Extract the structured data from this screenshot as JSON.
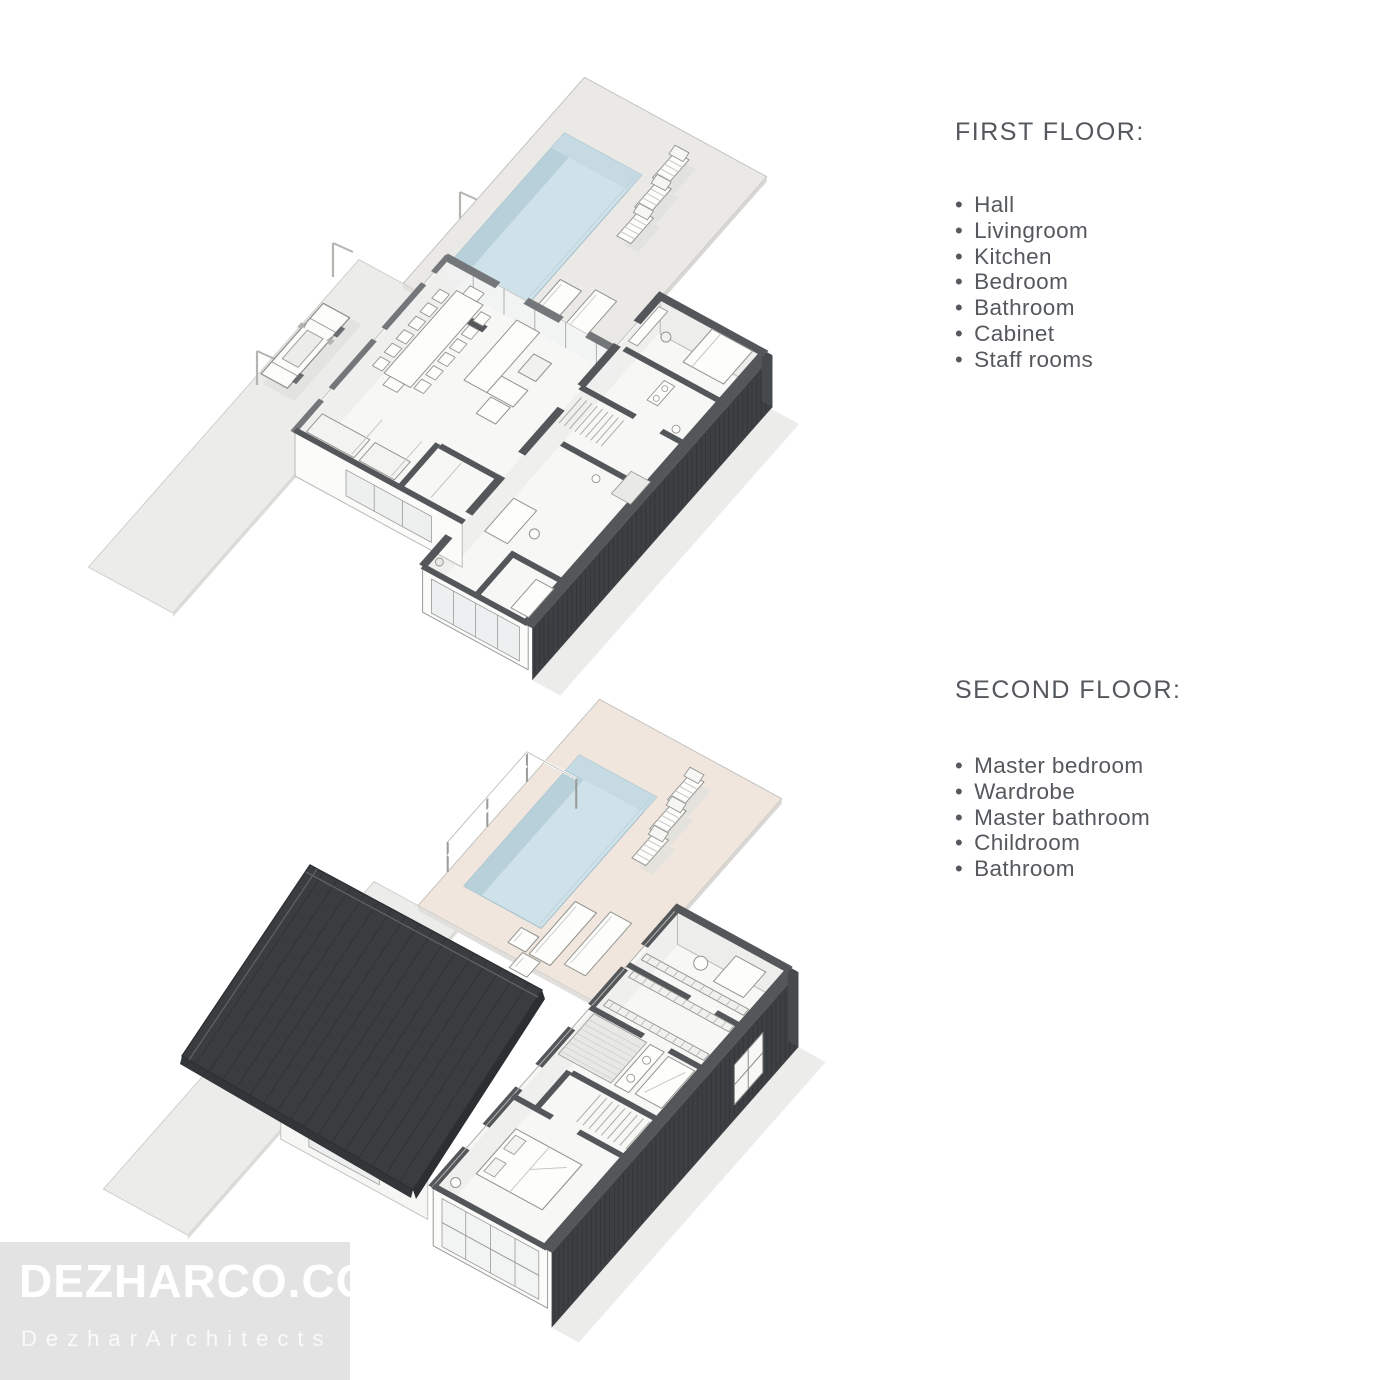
{
  "sections": [
    {
      "id": "first",
      "title": "FIRST FLOOR:",
      "items": [
        "Hall",
        "Livingroom",
        "Kitchen",
        "Bedroom",
        "Bathroom",
        "Cabinet",
        "Staff rooms"
      ]
    },
    {
      "id": "second",
      "title": "SECOND FLOOR:",
      "items": [
        "Master bedroom",
        "Wardrobe",
        "Master bathroom",
        "Childroom",
        "Bathroom"
      ]
    }
  ],
  "watermark": {
    "line1": "DEZHARCO.COM",
    "line2": "DezharArchitects"
  },
  "colors": {
    "pool_fill": "#cfe1e9",
    "pool_deep": "#b7d0da",
    "pool_mid": "#c5dae3",
    "pool_stroke": "#a3bfca",
    "deck_first": "#eae9e6",
    "deck_second": "#f0e6de",
    "deck_edge": "#d8d7d3",
    "ground": "#ececea",
    "slab": "#f7f7f5",
    "room_shade": "#e9e9e7",
    "wall_dark": "#54575a",
    "wall_mid": "#74777a",
    "facade": "#3d4043",
    "facade_slat": "#303336",
    "facade_top": "#54575a",
    "facade_end": "#474a4d",
    "roof": "#3a3d40",
    "roof_seam": "#2f3235",
    "roof_edge": "#2e3134",
    "line_soft": "#c3c3c0",
    "furn_stroke": "#94948f",
    "shadow": "#e0e0dd",
    "text": "#54585c",
    "watermark_bg": "#e3e3e3",
    "watermark_text": "#ffffff"
  }
}
